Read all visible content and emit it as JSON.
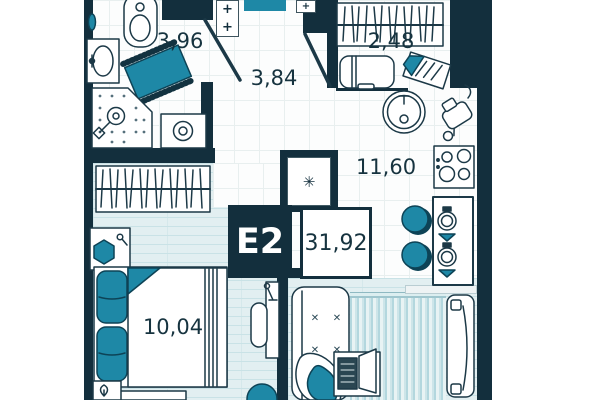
{
  "plan": {
    "unit_label": "E2",
    "total_area": "31,92",
    "rooms": {
      "bathroom": {
        "name": "bathroom",
        "area": "3,96"
      },
      "hallway": {
        "name": "hallway",
        "area": "3,84"
      },
      "closet": {
        "name": "wardrobe-closet",
        "area": "2,48"
      },
      "kitchen": {
        "name": "kitchen-living",
        "area": "11,60"
      },
      "bedroom": {
        "name": "bedroom",
        "area": "10,04"
      }
    },
    "icons": {
      "plus": "+",
      "snowflake": "✳",
      "cross": "✕"
    },
    "colors": {
      "wall": "#132f3d",
      "accent": "#1e88a6",
      "floor_light": "#e2eff1"
    }
  }
}
